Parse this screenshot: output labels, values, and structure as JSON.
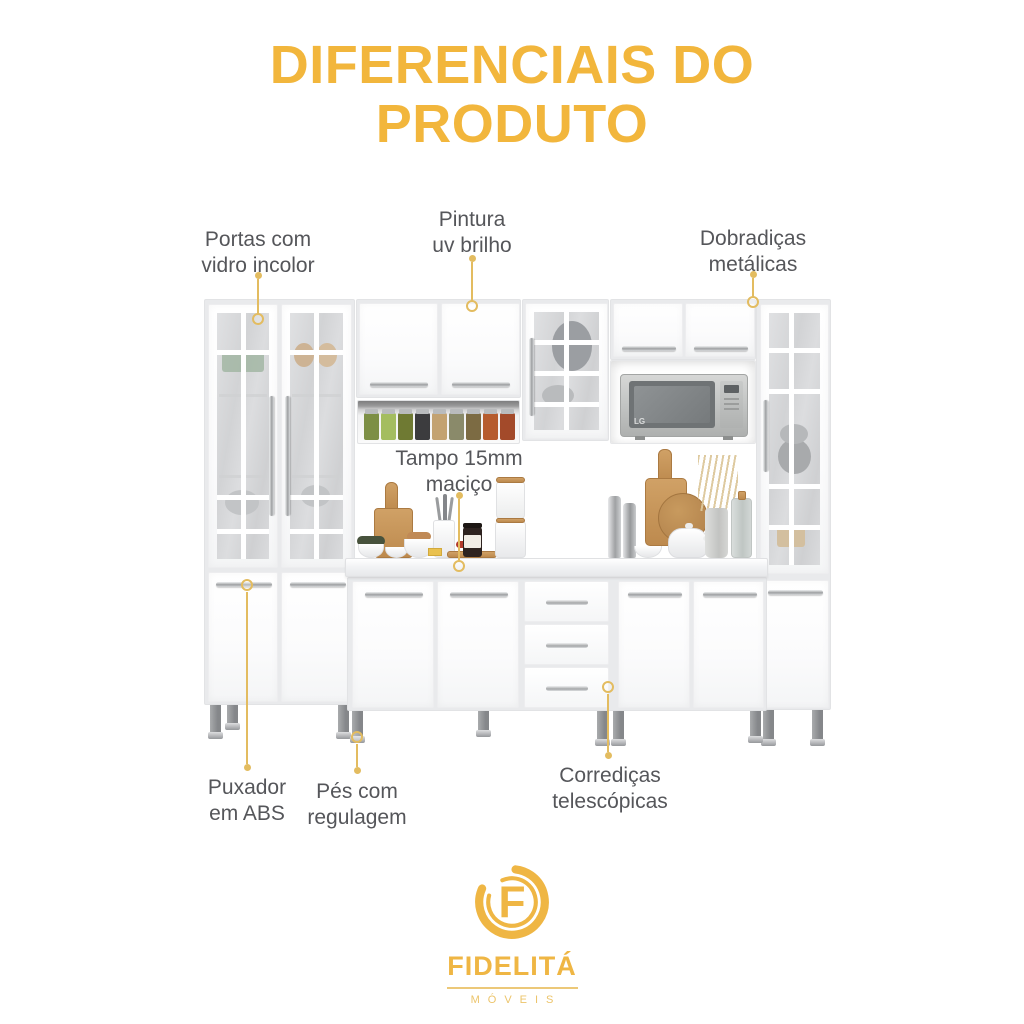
{
  "title": {
    "line1": "DIFERENCIAIS DO",
    "line2": "PRODUTO"
  },
  "callouts": {
    "portas": {
      "label": "Portas com\nvidro incolor"
    },
    "pintura": {
      "label": "Pintura\nuv brilho"
    },
    "dobradicas": {
      "label": "Dobradiças\nmetálicas"
    },
    "tampo": {
      "label": "Tampo 15mm\nmaciço"
    },
    "puxador": {
      "label": "Puxador\nem ABS"
    },
    "pes": {
      "label": "Pés com\nregulagem"
    },
    "corredicas": {
      "label": "Corrediças\ntelescópicas"
    }
  },
  "illustration": {
    "microwave_brand": "LG"
  },
  "logo": {
    "monogram": "F",
    "brand": "FIDELITÁ",
    "tagline": "MÓVEIS"
  },
  "colors": {
    "title_gold": "#F2B63C",
    "leader_gold": "#E3BC60",
    "label_gray": "#55565A",
    "logo_gold": "#EFB644"
  }
}
